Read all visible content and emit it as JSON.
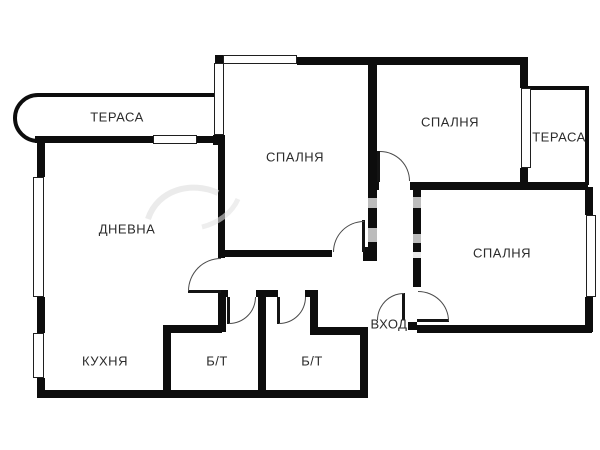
{
  "title": "Apartment floor plan",
  "colors": {
    "wall": "#0d0d0d",
    "door_arc": "#4a4a4a",
    "label_text": "#2b2b2b",
    "watermark": "#bcbcbc",
    "background": "#ffffff"
  },
  "rooms": [
    {
      "id": "terrace-1",
      "label": "ТЕРАСА"
    },
    {
      "id": "living-room",
      "label": "ДНЕВНА"
    },
    {
      "id": "kitchen",
      "label": "КУХНЯ"
    },
    {
      "id": "bedroom-1",
      "label": "СПАЛНЯ"
    },
    {
      "id": "bedroom-2",
      "label": "СПАЛНЯ"
    },
    {
      "id": "terrace-2",
      "label": "ТЕРАСА"
    },
    {
      "id": "bedroom-3",
      "label": "СПАЛНЯ"
    },
    {
      "id": "bathroom-1",
      "label": "Б/Т"
    },
    {
      "id": "bathroom-2",
      "label": "Б/Т"
    },
    {
      "id": "entrance",
      "label": "ВХОД"
    }
  ]
}
